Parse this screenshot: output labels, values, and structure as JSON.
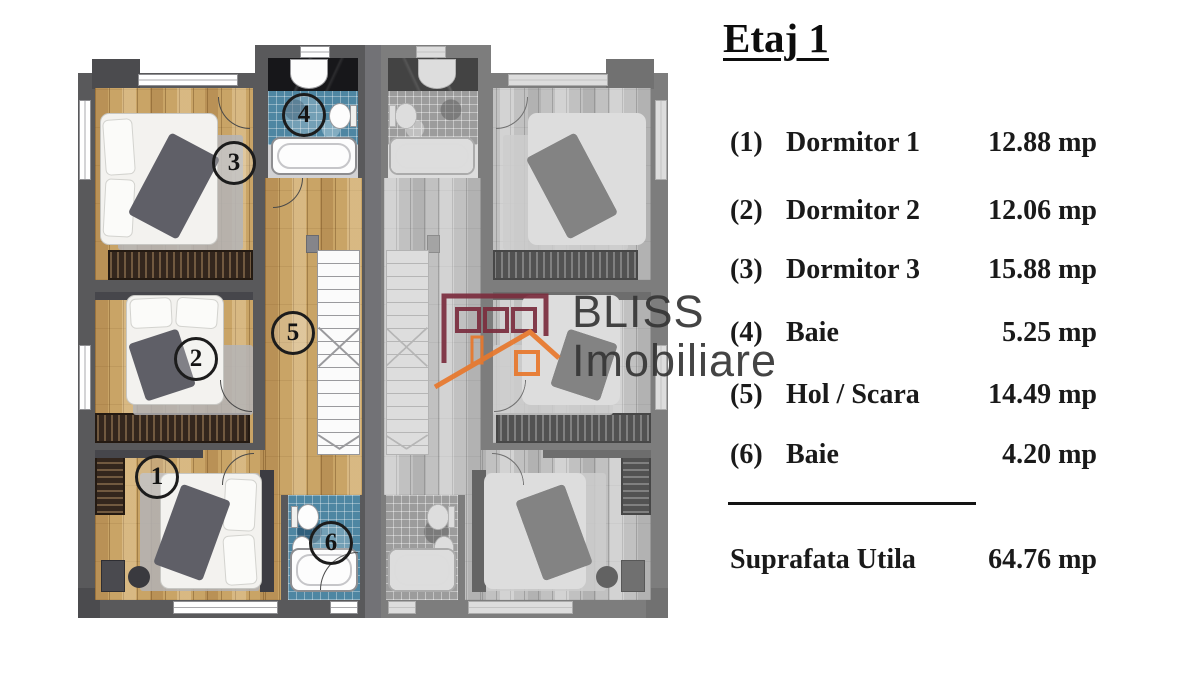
{
  "title": "Etaj 1",
  "legend": {
    "rows": [
      {
        "num": "(1)",
        "label": "Dormitor 1",
        "area": "12.88 mp"
      },
      {
        "num": "(2)",
        "label": "Dormitor 2",
        "area": "12.06 mp"
      },
      {
        "num": "(3)",
        "label": "Dormitor 3",
        "area": "15.88 mp"
      },
      {
        "num": "(4)",
        "label": "Baie",
        "area": "5.25 mp"
      },
      {
        "num": "(5)",
        "label": "Hol / Scara",
        "area": "14.49 mp"
      },
      {
        "num": "(6)",
        "label": "Baie",
        "area": "4.20 mp"
      }
    ],
    "total_label": "Suprafata Utila",
    "total_area": "64.76 mp"
  },
  "plan": {
    "room_numbers": [
      "1",
      "2",
      "3",
      "4",
      "5",
      "6"
    ]
  },
  "watermark": {
    "line1": "BLISS",
    "line2": "Imobiliare"
  },
  "colors": {
    "maroon": "#7b2d3e",
    "orange": "#e8782c",
    "wood": "#c9a466",
    "wall": "#59595b",
    "mosaic": "#4e86a2"
  }
}
